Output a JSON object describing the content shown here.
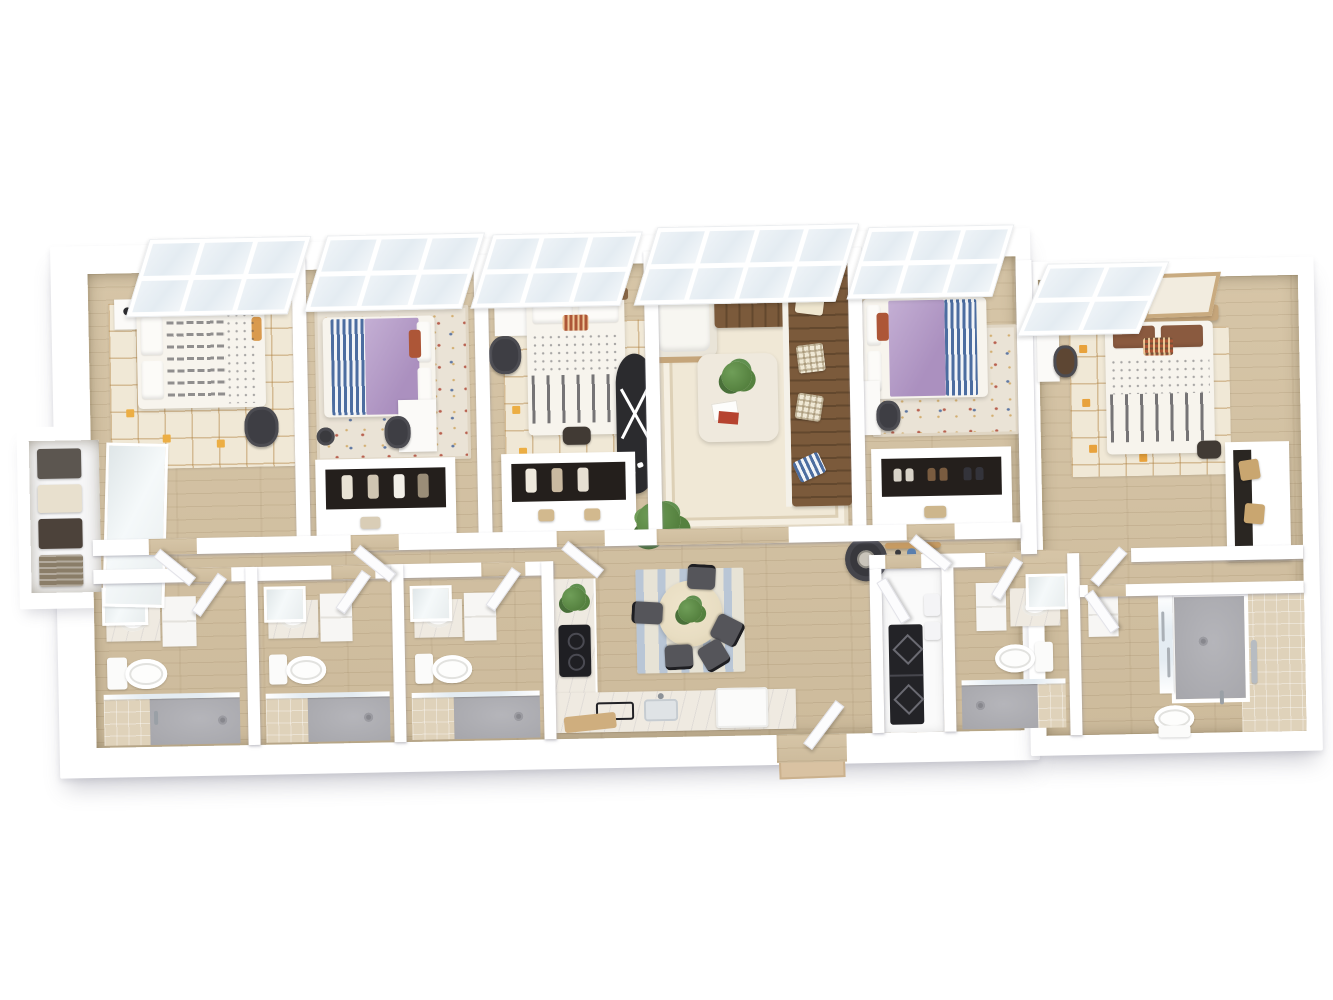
{
  "scene": {
    "type": "3D dollhouse floor plan rendering",
    "unit": "5 bedroom, 5 bathroom shared apartment",
    "view": "top-down isometric",
    "background": "white, no text labels"
  },
  "palette": {
    "wall": "#ffffff",
    "wall_edge": "#e7e7ec",
    "floor_wood": "#d6c5a7",
    "floor_wood_line": "#bfae8f",
    "rug_cream": "#f0e8d6",
    "rug_grid": "#c49a5e",
    "accent_yellow": "#ecae44",
    "accent_orange": "#e8a23c",
    "bed_white": "#f7f4ed",
    "duvet_purple": "#ab90bf",
    "duvet_purple_hi": "#c4afd4",
    "stripe_blue": "#4c6da0",
    "headboard_brown": "#8a6847",
    "headboard_tan": "#c5a57a",
    "pillow_rust": "#ad5637",
    "sofa_brown": "#7b5a3b",
    "sofa_brown_dark": "#63482e",
    "console_black": "#2b2b2e",
    "plant_green": "#55813f",
    "plant_green_hi": "#6f9e58",
    "chair_dark": "#55555a",
    "glass_blue": "#e4ecf2",
    "shower_gray": "#a6a6ab",
    "tile_beige": "#dfd2ba",
    "marble": "#efeae1",
    "cooktop_black": "#1f1f23",
    "table_wood": "#e8ddc2",
    "rug_stripe_blue": "#b9c6d6",
    "mirror_silver": "#e8edee",
    "box_tan": "#c9a670",
    "backpack_dark": "#413a34",
    "mat_tan": "#d9c2a2"
  },
  "rooms": [
    {
      "id": "bedroom-1",
      "name": "Bedroom 1",
      "furniture": [
        "bay window",
        "bed with dash-pattern duvet",
        "white pillows",
        "orange accent pillow",
        "nightstand with lamp",
        "desk chair",
        "cream grid rug with yellow accents"
      ]
    },
    {
      "id": "bedroom-2",
      "name": "Bedroom 2",
      "furniture": [
        "bay window",
        "bed with purple duvet",
        "blue striped blanket",
        "rust accent pillow",
        "desk",
        "desk chair",
        "oriental rug",
        "laundry basket"
      ]
    },
    {
      "id": "bedroom-3",
      "name": "Bedroom 3",
      "furniture": [
        "bay window",
        "desk with laptop and lamp",
        "desk chair",
        "bed with brown headboard",
        "patterned accent pillow",
        "striped duvet",
        "backpack",
        "cream grid rug with yellow accents"
      ]
    },
    {
      "id": "living-room",
      "name": "Living Room",
      "furniture": [
        "bay window",
        "white armchair",
        "brown sectional sofa",
        "striped and checkered throw pillows",
        "coffee table with plant and magazines",
        "black oval console",
        "floor plant",
        "round side table",
        "bordered cream rug"
      ]
    },
    {
      "id": "bedroom-4",
      "name": "Bedroom 4",
      "furniture": [
        "bay window",
        "bed with purple duvet",
        "blue striped blanket",
        "rust accent pillow",
        "desk",
        "desk chair",
        "oriental rug",
        "shoe closet",
        "skateboard shelf"
      ]
    },
    {
      "id": "bedroom-5",
      "name": "Bedroom 5",
      "furniture": [
        "window",
        "framed wall art",
        "bed with wood headboard",
        "patterned accent pillow",
        "striped duvet",
        "backpack",
        "desk",
        "desk chair",
        "cream grid rug with orange accents",
        "storage closet with boxes"
      ]
    },
    {
      "id": "bathroom-1",
      "name": "Bathroom 1",
      "furniture": [
        "vanity with mirror",
        "storage cabinet",
        "toilet",
        "glass walk-in shower",
        "tiled shower wall"
      ]
    },
    {
      "id": "bathroom-2",
      "name": "Bathroom 2",
      "furniture": [
        "vanity with mirror",
        "storage cabinet",
        "toilet",
        "glass walk-in shower",
        "tiled shower wall"
      ]
    },
    {
      "id": "bathroom-3",
      "name": "Bathroom 3",
      "furniture": [
        "vanity with mirror",
        "storage cabinet",
        "toilet",
        "glass walk-in shower",
        "tiled shower wall",
        "entry door"
      ]
    },
    {
      "id": "kitchen",
      "name": "Kitchen",
      "furniture": [
        "L-shaped counter",
        "marble countertop",
        "cooktop",
        "sink",
        "serving tray",
        "cutting board",
        "potted plant",
        "dishwasher"
      ]
    },
    {
      "id": "dining-area",
      "name": "Dining Area",
      "furniture": [
        "round dining table",
        "plant centerpiece",
        "five dark chairs",
        "striped area rug"
      ]
    },
    {
      "id": "entry",
      "name": "Entry",
      "furniture": [
        "entry door",
        "door mat"
      ]
    },
    {
      "id": "utility-closet",
      "name": "Utility Closet",
      "furniture": [
        "stacked washer and dryer",
        "wall cabinets",
        "closet door"
      ]
    },
    {
      "id": "bathroom-4",
      "name": "Bathroom 4",
      "furniture": [
        "vanity with mirror",
        "storage cabinet",
        "toilet",
        "glass walk-in shower",
        "tiled shower wall"
      ]
    },
    {
      "id": "bathroom-5",
      "name": "Bathroom 5",
      "furniture": [
        "walk-in shower with glass doors",
        "grab bar",
        "hand shower",
        "toilet",
        "tiled floor and walls",
        "entry door"
      ]
    },
    {
      "id": "hall-closet",
      "name": "Hall Storage Closet",
      "furniture": [
        "open shelving",
        "storage baskets",
        "sliding mirror door"
      ]
    },
    {
      "id": "hallway",
      "name": "Hallway",
      "furniture": [
        "wood flooring",
        "bedroom and bathroom doors"
      ]
    }
  ],
  "counts": {
    "bedrooms": 5,
    "bathrooms": 5,
    "closets": 5,
    "windows": 6
  }
}
